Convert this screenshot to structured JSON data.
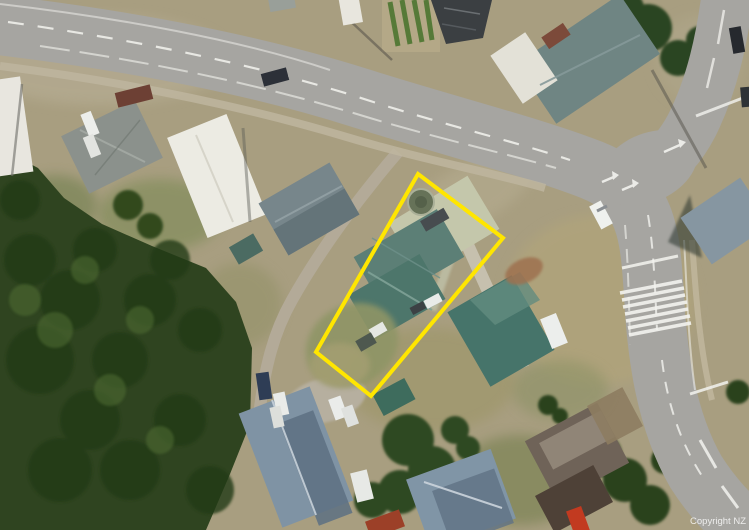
{
  "map": {
    "type": "satellite-aerial-view",
    "watermark": "Copyright NZ",
    "boundary": {
      "name": "property-boundary-highlight",
      "color": "#FFE600",
      "stroke_width": 4
    },
    "palette": {
      "ground": "#A89E80",
      "road": "#A6A5A1",
      "lane": "#B3AA98",
      "forest": "#2F4420",
      "marking": "#F3F3EF",
      "roof_teal": "#4D766B",
      "roof_slate": "#8095A6",
      "roof_white": "#ECEBE3",
      "roof_charcoal": "#3B3F42",
      "dry_grass": "#B3A679",
      "lawn": "#7B8A55"
    },
    "features": [
      "curved-main-road",
      "side-road-north-east",
      "narrow-lane-south-west",
      "pedestrian-crossing",
      "intersection-turn-arrows",
      "bush-reserve-south-west",
      "residential-roofs",
      "parked-vehicles",
      "round-tank-in-property"
    ]
  }
}
